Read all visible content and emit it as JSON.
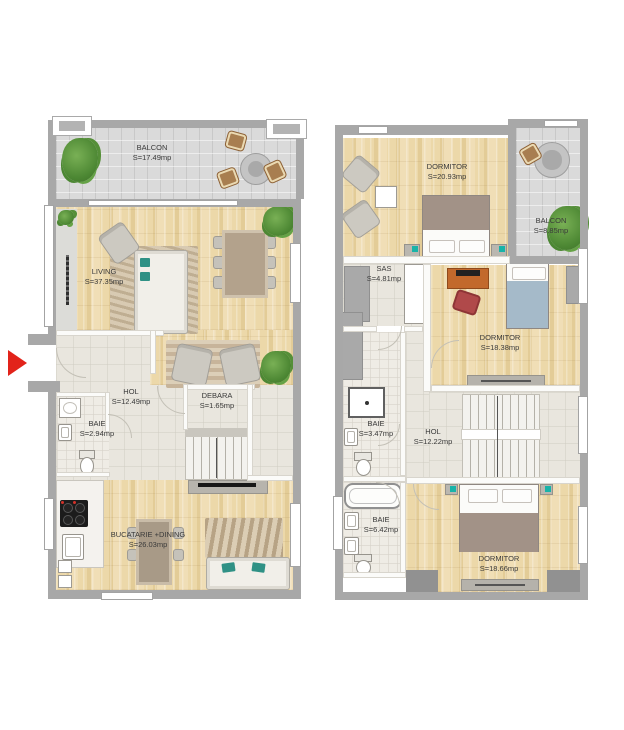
{
  "plans": [
    {
      "title": "ground-floor",
      "rooms": [
        {
          "label": "BALCON",
          "area": "S=17.49mp"
        },
        {
          "label": "LIVING",
          "area": "S=37.35mp"
        },
        {
          "label": "HOL",
          "area": "S=12.49mp"
        },
        {
          "label": "DEBARA",
          "area": "S=1.65mp"
        },
        {
          "label": "BAIE",
          "area": "S=2.94mp"
        },
        {
          "label": "BUCATARIE +DINING",
          "area": "S=26.03mp"
        }
      ]
    },
    {
      "title": "upper-floor",
      "rooms": [
        {
          "label": "DORMITOR",
          "area": "S=20.93mp"
        },
        {
          "label": "BALCON",
          "area": "S=8.85mp"
        },
        {
          "label": "SAS",
          "area": "S=4.81mp"
        },
        {
          "label": "DORMITOR",
          "area": "S=18.38mp"
        },
        {
          "label": "BAIE",
          "area": "S=3.47mp"
        },
        {
          "label": "HOL",
          "area": "S=12.22mp"
        },
        {
          "label": "BAIE",
          "area": "S=6.42mp"
        },
        {
          "label": "DORMITOR",
          "area": "S=18.66mp"
        }
      ]
    }
  ],
  "colors": {
    "wood_floor": "#ecd8a9",
    "balcony_tile": "#dadada",
    "hall_tile": "#e9e6de",
    "wall": "#a8a8a8",
    "entrance_arrow": "#e2231a",
    "accent_teal": "#2f9185"
  }
}
